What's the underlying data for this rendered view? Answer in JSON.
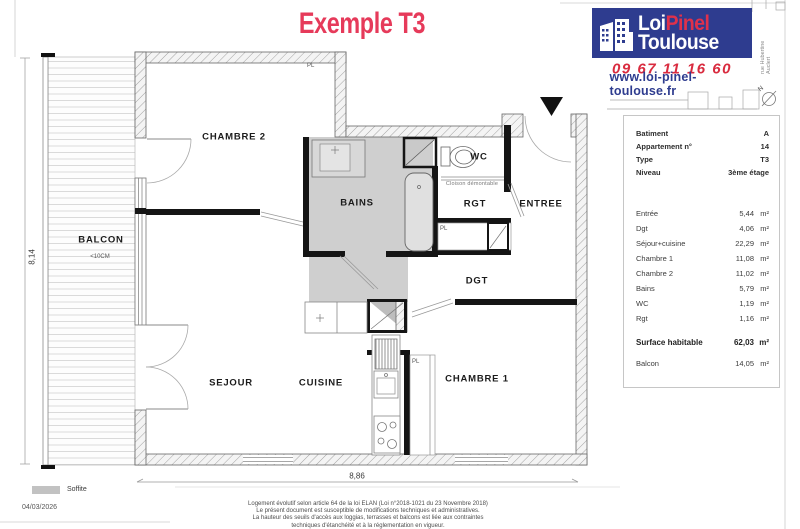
{
  "page": {
    "title": "Exemple T3"
  },
  "brand": {
    "name_part1": "Loi",
    "name_part2": "Pinel",
    "name_line2": "Toulouse",
    "phone": "09 67 11 16 60",
    "website": "www.loi-pinel-toulouse.fr",
    "street": "rue Hubertine Auclert",
    "compass": "N",
    "colors": {
      "blue": "#2e3c8f",
      "red": "#d92b3f",
      "title_pink": "#e63a5a"
    }
  },
  "info": {
    "rows": [
      {
        "label": "Batiment",
        "value": "A"
      },
      {
        "label": "Appartement n°",
        "value": "14"
      },
      {
        "label": "Type",
        "value": "T3"
      },
      {
        "label": "Niveau",
        "value": "3ème étage"
      }
    ]
  },
  "areas": {
    "unit": "m²",
    "rows": [
      {
        "label": "Entrée",
        "value": "5,44"
      },
      {
        "label": "Dgt",
        "value": "4,06"
      },
      {
        "label": "Séjour+cuisine",
        "value": "22,29"
      },
      {
        "label": "Chambre 1",
        "value": "11,08"
      },
      {
        "label": "Chambre 2",
        "value": "11,02"
      },
      {
        "label": "Bains",
        "value": "5,79"
      },
      {
        "label": "WC",
        "value": "1,19"
      },
      {
        "label": "Rgt",
        "value": "1,16"
      }
    ],
    "total": {
      "label": "Surface habitable",
      "value": "62,03"
    },
    "balcony": {
      "label": "Balcon",
      "value": "14,05"
    }
  },
  "plan": {
    "rooms": {
      "balcon": "BALCON",
      "chambre2": "CHAMBRE 2",
      "bains": "BAINS",
      "wc": "WC",
      "rgt": "RGT",
      "entree": "ENTREE",
      "dgt": "DGT",
      "sejour": "SEJOUR",
      "cuisine": "CUISINE",
      "chambre1": "CHAMBRE 1"
    },
    "balcony_note": "<10CM",
    "closet_label": "PL",
    "partition_note": "Cloison démontable",
    "dim_height": "8,14",
    "dim_width": "8,86"
  },
  "footer": {
    "legend_label": "Soffite",
    "date": "04/03/2026",
    "disclaimer": [
      "Logement évolutif selon article 64 de la loi ELAN (Loi n°2018-1021 du 23 Novembre 2018)",
      "Le présent document est susceptible de modifications techniques et administratives.",
      "La hauteur des seuils d'accès aux loggias, terrasses et balcons est liée aux contraintes",
      "techniques d'étanchéité et à la réglementation en vigueur."
    ]
  }
}
